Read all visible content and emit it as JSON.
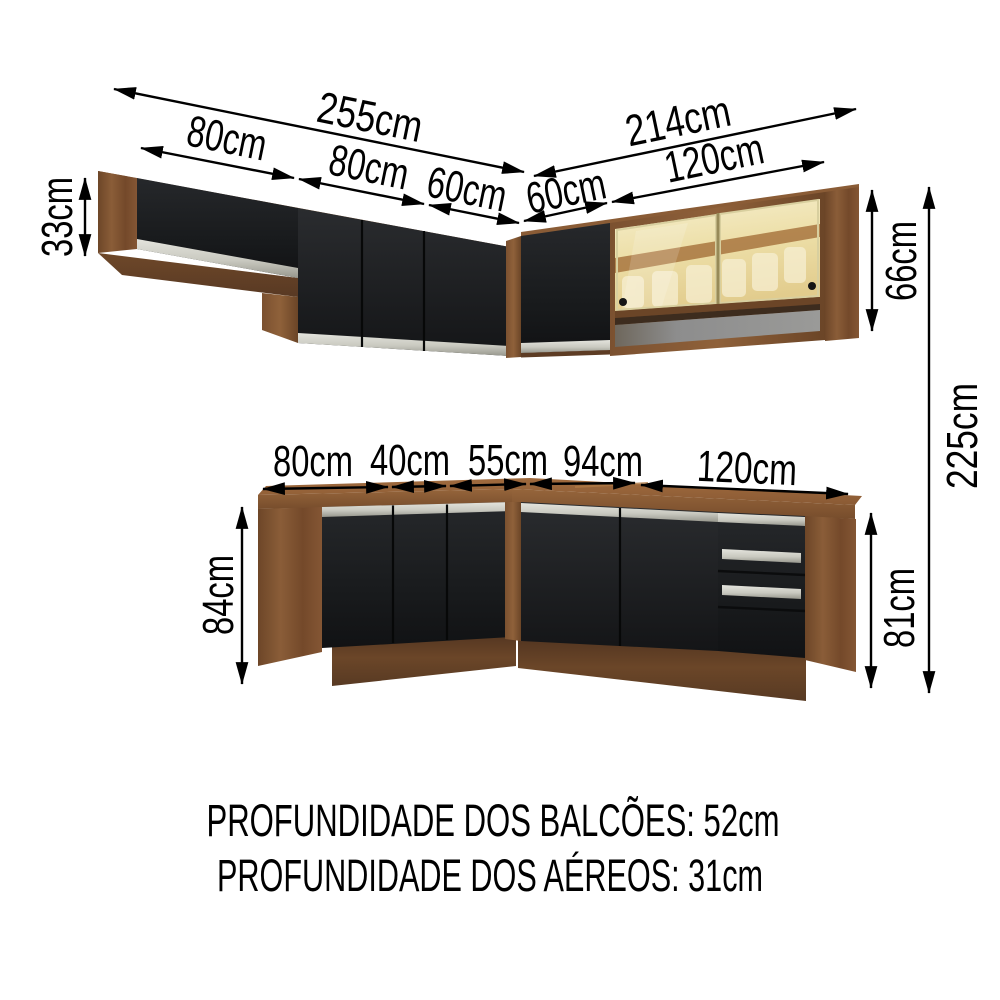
{
  "diagram": {
    "title_context": "kitchen cabinet set dimension diagram",
    "upper": {
      "left_total": "255cm",
      "left_segments": [
        "80cm",
        "80cm",
        "60cm"
      ],
      "right_total": "214cm",
      "right_segments": [
        "60cm",
        "120cm"
      ],
      "short_cabinet_height": "33cm",
      "tall_cabinet_height": "66cm"
    },
    "base": {
      "segments": [
        "80cm",
        "40cm",
        "55cm",
        "94cm",
        "120cm"
      ],
      "left_height": "84cm",
      "right_height": "81cm"
    },
    "overall_height": "225cm",
    "footnotes": [
      "PROFUNDIDADE DOS BALCÕES: 52cm",
      "PROFUNDIDADE DOS AÉREOS: 31cm"
    ],
    "colors": {
      "background": "#ffffff",
      "dimension_lines": "#000000",
      "wood_side": "#7b5130",
      "wood_light": "#9c6a3d",
      "wood_dark": "#5f3e26",
      "door_black": "#1b1d1f",
      "handle_silver": "#d2d2ca",
      "glass_amber": "#eedfa8",
      "open_shelf_gray": "#8d8d8d"
    }
  }
}
